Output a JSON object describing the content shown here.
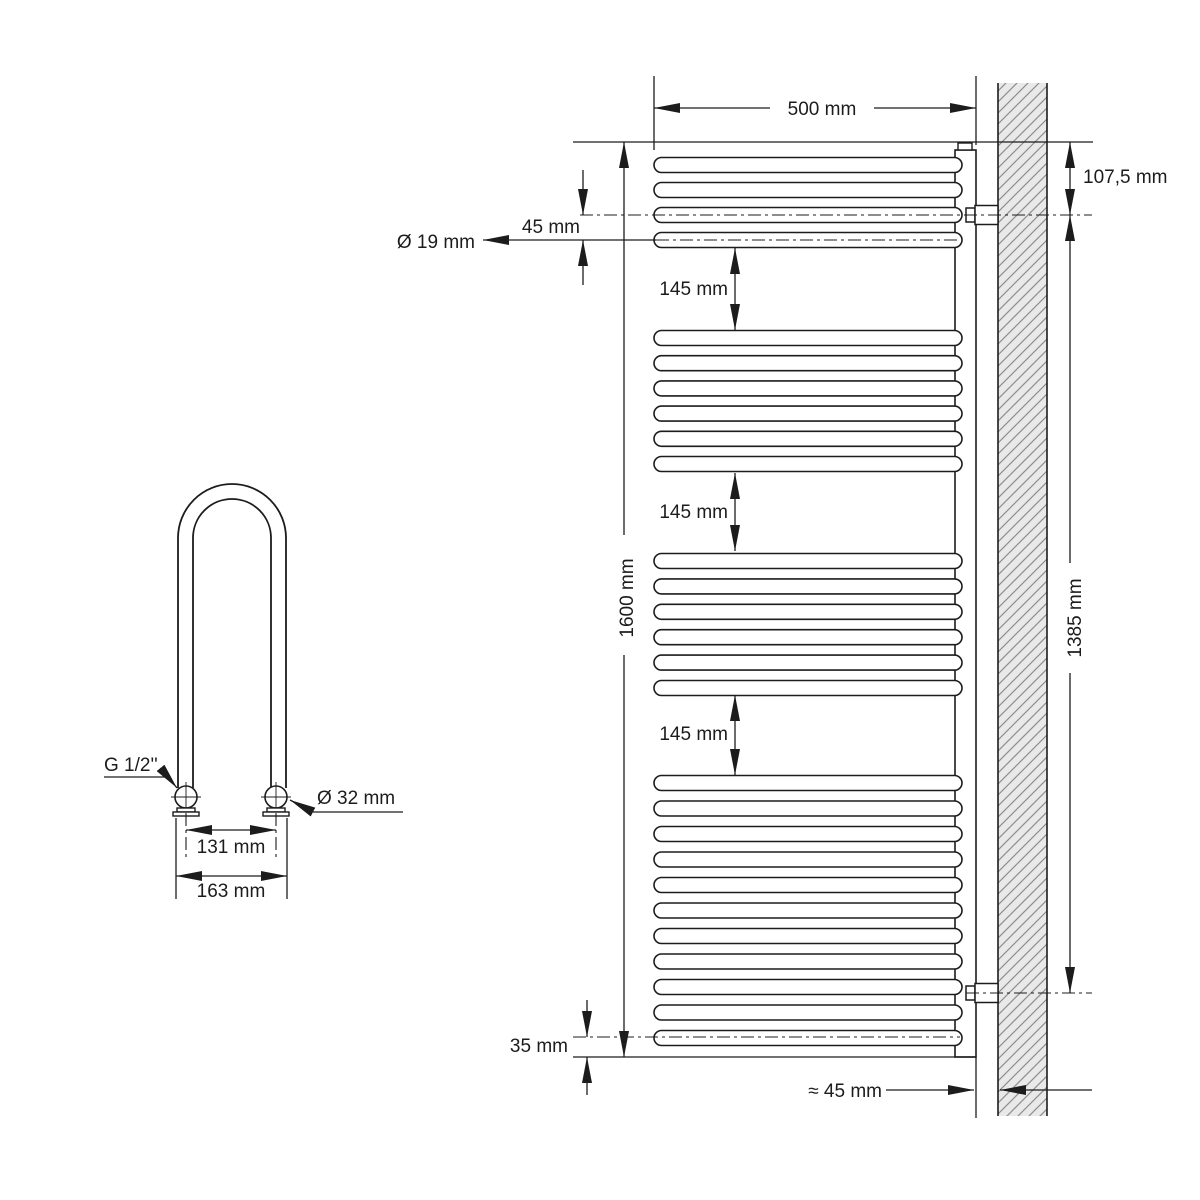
{
  "drawing": {
    "front_view": {
      "dim_width": "500 mm",
      "dim_top_connection_offset": "107,5 mm",
      "dim_tube_pitch": "45 mm",
      "dim_tube_diameter": "Ø 19 mm",
      "dim_section_gap": "145 mm",
      "dim_total_height": "1600 mm",
      "dim_connection_span": "1385 mm",
      "dim_bottom_offset": "35 mm",
      "dim_wall_clearance": "≈ 45 mm",
      "rung_groups": [
        [
          165,
          190,
          215,
          240
        ],
        [
          338,
          363.2,
          388.4,
          413.6,
          438.8,
          464
        ],
        [
          561,
          586.4,
          611.8,
          637.2,
          662.6,
          688
        ],
        [
          783,
          808.5,
          834,
          859.5,
          885,
          910.5,
          936,
          961.5,
          987,
          1012.5,
          1038
        ]
      ],
      "valve_centers": [
        215,
        993
      ]
    },
    "side_view": {
      "label_thread": "G 1/2''",
      "dim_fitting_diameter": "Ø 32 mm",
      "dim_connection_spacing": "131 mm",
      "dim_outer_width": "163 mm"
    },
    "colors": {
      "line": "#1c1c1c",
      "wall_fill": "#e9e9e9",
      "wall_hatch": "#8e8e8e"
    }
  }
}
